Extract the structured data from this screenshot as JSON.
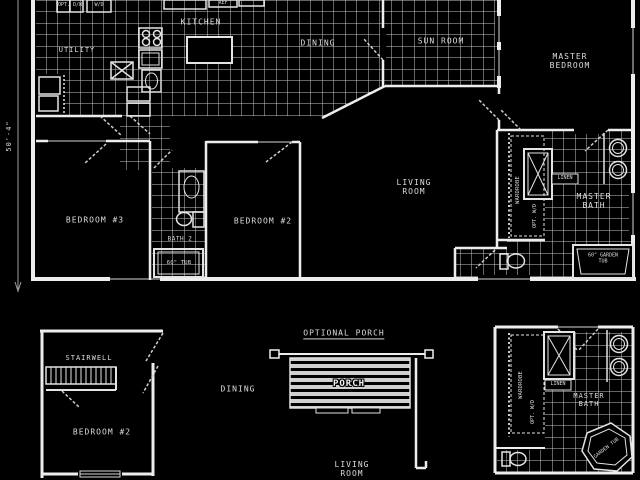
{
  "canvas": {
    "background": "#000000",
    "line_color": "#ededed",
    "tile_line_color": "#c8c8c8"
  },
  "dimension": {
    "left_vertical": "50'-4\""
  },
  "upper_plan": {
    "rooms": {
      "utility": "UTILITY",
      "kitchen": "KITCHEN",
      "dining": "DINING",
      "sun_room": "SUN ROOM",
      "master_bedroom_line1": "MASTER",
      "master_bedroom_line2": "BEDROOM",
      "living_room_line1": "LIVING",
      "living_room_line2": "ROOM",
      "bedroom3": "BEDROOM #3",
      "bedroom2": "BEDROOM #2",
      "bath2": "BATH 2",
      "master_bath_line1": "MASTER",
      "master_bath_line2": "BATH"
    },
    "fixtures": {
      "tub": "60\" TUB",
      "linen": "LINEN",
      "wardrobe": "WARDROBE",
      "opt_wd": "OPT. W/D",
      "garden_tub_line1": "60\" GARDEN",
      "garden_tub_line2": "TUB",
      "ref": "REF",
      "opt_dw": "OPT. D/W",
      "wd": "W/D"
    }
  },
  "lower_left_plan": {
    "rooms": {
      "stairwell": "STAIRWELL",
      "dining": "DINING",
      "bedroom2": "BEDROOM #2"
    }
  },
  "porch_plan": {
    "heading": "OPTIONAL PORCH",
    "porch": "PORCH",
    "living_room_line1": "LIVING",
    "living_room_line2": "ROOM"
  },
  "lower_right_plan": {
    "master_bath_line1": "MASTER",
    "master_bath_line2": "BATH",
    "linen": "LINEN",
    "wardrobe": "WARDROBE",
    "opt_wd": "OPT. W/D",
    "garden_tub": "GARDEN TUB"
  }
}
